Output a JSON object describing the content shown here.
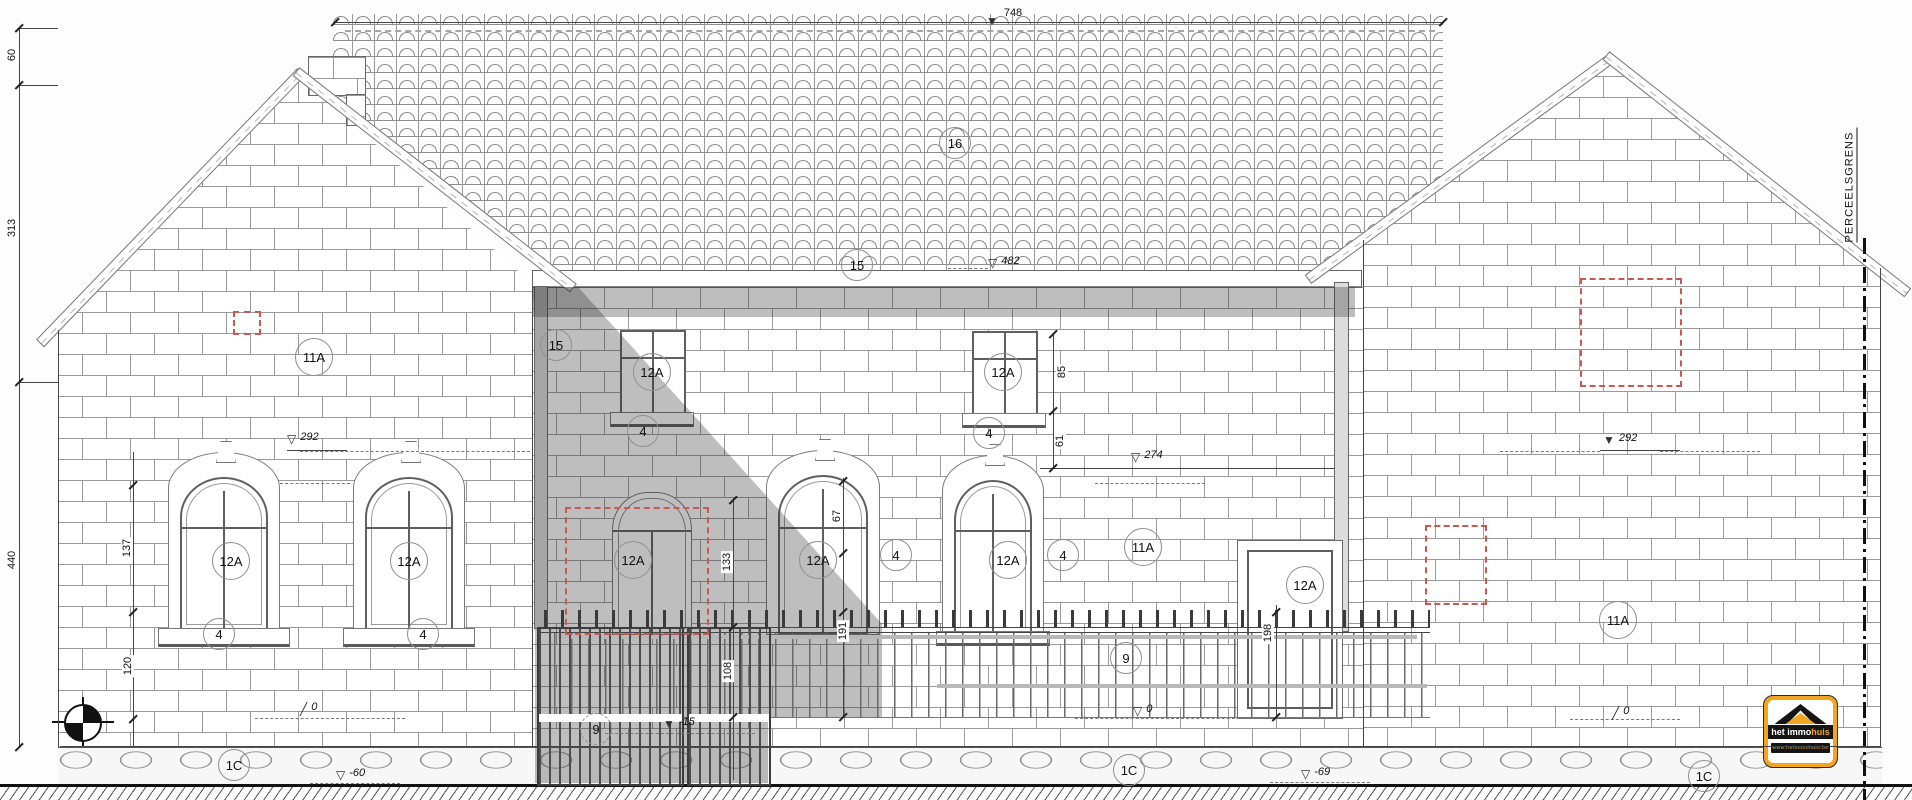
{
  "labels": {
    "boundary": "PERCEELSGRENS",
    "logo": {
      "brand_bold": "het immo",
      "brand_accent": "huis",
      "url": "www.hetimmohuis.be"
    }
  },
  "colors": {
    "accent_orange": "#f2a51e",
    "red_dash": "#c65a50",
    "line": "#555555"
  },
  "drawing": {
    "type": "architectural front elevation with part callouts and level markers",
    "bubbles": [
      {
        "x": 955,
        "y": 143,
        "t": "16"
      },
      {
        "x": 857,
        "y": 265,
        "t": "15"
      },
      {
        "x": 556,
        "y": 345,
        "t": "15"
      },
      {
        "x": 314,
        "y": 357,
        "t": "11A"
      },
      {
        "x": 231,
        "y": 561,
        "t": "12A"
      },
      {
        "x": 409,
        "y": 561,
        "t": "12A"
      },
      {
        "x": 219,
        "y": 634,
        "t": "4"
      },
      {
        "x": 423,
        "y": 634,
        "t": "4"
      },
      {
        "x": 652,
        "y": 372,
        "t": "12A"
      },
      {
        "x": 643,
        "y": 431,
        "t": "4"
      },
      {
        "x": 1003,
        "y": 372,
        "t": "12A"
      },
      {
        "x": 989,
        "y": 433,
        "t": "4"
      },
      {
        "x": 633,
        "y": 560,
        "t": "12A"
      },
      {
        "x": 818,
        "y": 560,
        "t": "12A"
      },
      {
        "x": 896,
        "y": 555,
        "t": "4"
      },
      {
        "x": 1008,
        "y": 560,
        "t": "12A"
      },
      {
        "x": 1063,
        "y": 555,
        "t": "4"
      },
      {
        "x": 1143,
        "y": 547,
        "t": "11A"
      },
      {
        "x": 1305,
        "y": 585,
        "t": "12A"
      },
      {
        "x": 1618,
        "y": 620,
        "t": "11A"
      },
      {
        "x": 596,
        "y": 729,
        "t": "9",
        "dash": true
      },
      {
        "x": 1126,
        "y": 658,
        "t": "9"
      },
      {
        "x": 234,
        "y": 765,
        "t": "1C"
      },
      {
        "x": 1129,
        "y": 770,
        "t": "1C"
      },
      {
        "x": 1704,
        "y": 776,
        "t": "1C"
      }
    ],
    "vdims": [
      {
        "x": 12,
        "y": 55,
        "t": "60"
      },
      {
        "x": 12,
        "y": 228,
        "t": "313"
      },
      {
        "x": 12,
        "y": 560,
        "t": "440"
      },
      {
        "x": 127,
        "y": 548,
        "t": "137"
      },
      {
        "x": 128,
        "y": 666,
        "t": "120"
      },
      {
        "x": 1062,
        "y": 372,
        "t": "85"
      },
      {
        "x": 1060,
        "y": 441,
        "t": "61"
      },
      {
        "x": 837,
        "y": 516,
        "t": "67"
      },
      {
        "x": 727,
        "y": 562,
        "t": "133"
      },
      {
        "x": 728,
        "y": 671,
        "t": "108"
      },
      {
        "x": 843,
        "y": 631,
        "t": "191"
      },
      {
        "x": 1268,
        "y": 633,
        "t": "198"
      }
    ],
    "markers": [
      {
        "k": "plain",
        "t": "748",
        "x": 1013,
        "y": 13
      },
      {
        "k": "filled",
        "t": "",
        "x": 986,
        "y": 22
      },
      {
        "k": "open",
        "t": "482",
        "x": 988,
        "y": 264
      },
      {
        "k": "open",
        "t": "292",
        "x": 287,
        "y": 440
      },
      {
        "k": "open",
        "t": "274",
        "x": 1131,
        "y": 458
      },
      {
        "k": "filled",
        "t": "292",
        "x": 1603,
        "y": 441
      },
      {
        "k": "open",
        "t": "0",
        "x": 1133,
        "y": 712
      },
      {
        "k": "tick",
        "t": "0",
        "x": 300,
        "y": 710
      },
      {
        "k": "tick",
        "t": "0",
        "x": 1612,
        "y": 714
      },
      {
        "k": "filled",
        "t": "-15",
        "x": 663,
        "y": 725
      },
      {
        "k": "open",
        "t": "-60",
        "x": 336,
        "y": 776
      },
      {
        "k": "open",
        "t": "-69",
        "x": 1301,
        "y": 775
      }
    ],
    "lines": [
      [
        19,
        28,
        1,
        719
      ],
      [
        133,
        452,
        1,
        295
      ],
      [
        1053,
        333,
        1,
        135
      ],
      [
        733,
        498,
        1,
        282
      ],
      [
        843,
        478,
        1,
        239
      ],
      [
        1276,
        605,
        1,
        112
      ],
      [
        335,
        22,
        1108,
        1
      ],
      [
        1040,
        468,
        295,
        1
      ],
      [
        19,
        28,
        39,
        1
      ],
      [
        19,
        85,
        39,
        1
      ],
      [
        19,
        382,
        39,
        1
      ],
      [
        287,
        450,
        60,
        1
      ],
      [
        1600,
        450,
        80,
        1
      ],
      [
        58,
        330,
        1,
        417
      ],
      [
        1880,
        268,
        1,
        479
      ],
      [
        532,
        287,
        1,
        460
      ],
      [
        1363,
        240,
        1,
        507
      ],
      [
        60,
        746,
        1820,
        1
      ]
    ],
    "dashes": [
      [
        300,
        451,
        230
      ],
      [
        280,
        483,
        70
      ],
      [
        1095,
        483,
        110
      ],
      [
        948,
        268,
        40
      ],
      [
        1500,
        451,
        100
      ],
      [
        1660,
        451,
        100
      ],
      [
        255,
        718,
        150
      ],
      [
        1075,
        718,
        190
      ],
      [
        1570,
        719,
        110
      ],
      [
        605,
        733,
        150
      ],
      [
        310,
        783,
        90
      ],
      [
        1270,
        782,
        100
      ]
    ],
    "ticks": [
      [
        19,
        28
      ],
      [
        19,
        85
      ],
      [
        19,
        382
      ],
      [
        19,
        747
      ],
      [
        133,
        485
      ],
      [
        133,
        612
      ],
      [
        133,
        719
      ],
      [
        1053,
        334
      ],
      [
        1053,
        411
      ],
      [
        1053,
        468
      ],
      [
        733,
        500
      ],
      [
        733,
        627
      ],
      [
        733,
        717
      ],
      [
        843,
        481
      ],
      [
        843,
        553
      ],
      [
        843,
        612
      ],
      [
        843,
        717
      ],
      [
        1276,
        612
      ],
      [
        1276,
        717
      ],
      [
        335,
        22
      ],
      [
        1443,
        22
      ]
    ],
    "red_rects": [
      [
        233,
        311,
        24,
        20
      ],
      [
        565,
        507,
        140,
        124
      ],
      [
        1425,
        525,
        58,
        76
      ],
      [
        1580,
        278,
        98,
        105
      ]
    ]
  }
}
